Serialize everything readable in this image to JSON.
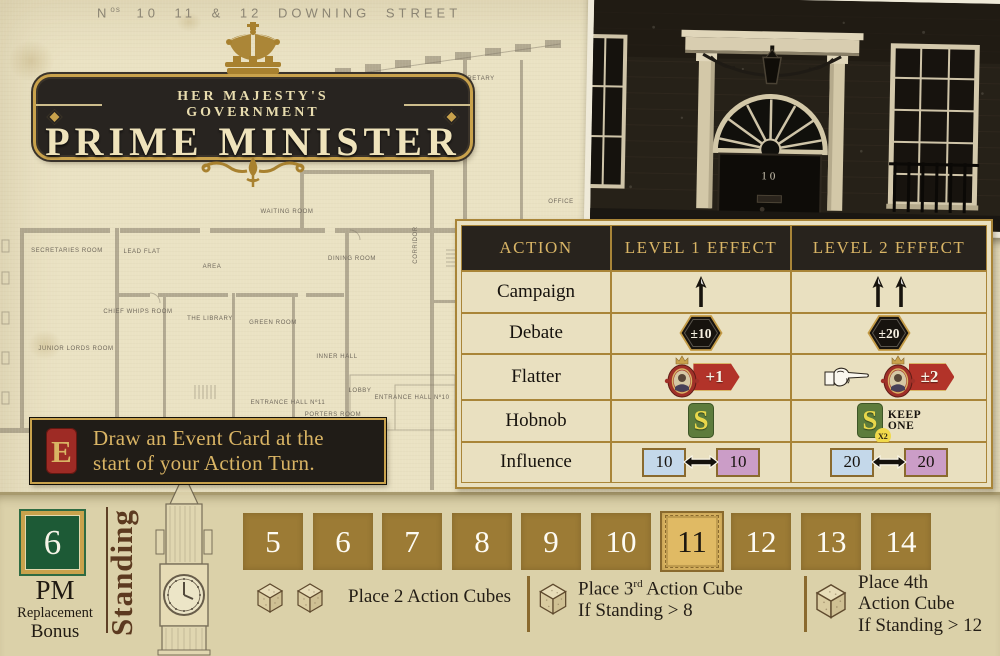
{
  "street_caption": {
    "n": "N",
    "sup": "os",
    "rest": "10 11 & 12  DOWNING  STREET"
  },
  "banner": {
    "subtitle": "HER MAJESTY'S  GOVERNMENT",
    "title": "PRIME MINISTER"
  },
  "photo": {
    "door_number": "10"
  },
  "plan": {
    "labels": [
      "SECRETARIES ROOM",
      "LEAD FLAT",
      "AREA",
      "WAITING ROOM",
      "DINING ROOM",
      "CORRIDOR",
      "CHIEF WHIPS ROOM",
      "THE LIBRARY",
      "GREEN ROOM",
      "JUNIOR LORDS ROOM",
      "INNER HALL",
      "ENTRANCE HALL Nº11",
      "PORTERS ROOM",
      "LOBBY",
      "ENTRANCE HALL Nº10",
      "OFFICE",
      "OFFICE",
      "SECRETARY"
    ]
  },
  "effects_table": {
    "headers": [
      "ACTION",
      "LEVEL 1 EFFECT",
      "LEVEL 2 EFFECT"
    ],
    "rows": {
      "campaign": {
        "label": "Campaign",
        "level1_arrows": 1,
        "level2_arrows": 2
      },
      "debate": {
        "label": "Debate",
        "level1": "±10",
        "level2": "±20"
      },
      "flatter": {
        "label": "Flatter",
        "level1": "+1",
        "level2": "±2"
      },
      "hobnob": {
        "label": "Hobnob",
        "s": "S",
        "x2": "X2",
        "keep1": "KEEP",
        "keep2": "ONE"
      },
      "influence": {
        "label": "Influence",
        "l1_left": "10",
        "l1_right": "10",
        "l2_left": "20",
        "l2_right": "20"
      }
    }
  },
  "event_box": {
    "letter": "E",
    "line1": "Draw an Event Card at the",
    "line2": "start of your Action Turn."
  },
  "standing_bar": {
    "bonus_value": "6",
    "bonus_title": "PM",
    "bonus_sub1": "Replacement",
    "bonus_sub2": "Bonus",
    "axis_label": "Standing",
    "track": [
      "5",
      "6",
      "7",
      "8",
      "9",
      "10",
      "11",
      "12",
      "13",
      "14"
    ],
    "current_space": "11",
    "rule_2cubes": "Place 2 Action Cubes",
    "rule_3rd_pre": "Place 3",
    "rule_3rd_sup": "rd",
    "rule_3rd_post": " Action Cube",
    "rule_3rd_line2": "If Standing > 8",
    "rule_4th_line1": "Place 4th",
    "rule_4th_line2": "Action Cube",
    "rule_4th_line3": "If Standing > 12"
  },
  "colors": {
    "paper": "#eae2c3",
    "gold": "#c9a24c",
    "plaque_dark": "#282420",
    "track_brown": "#9c7b35",
    "highlight_tile": "#e0ba64",
    "bonus_green": "#1d5a36",
    "event_red": "#9e2b25",
    "flag_red": "#b23329",
    "hobnob_green": "#5d7c3c",
    "influence_blue": "#c4d8ea",
    "influence_purple": "#cb9dc7"
  }
}
